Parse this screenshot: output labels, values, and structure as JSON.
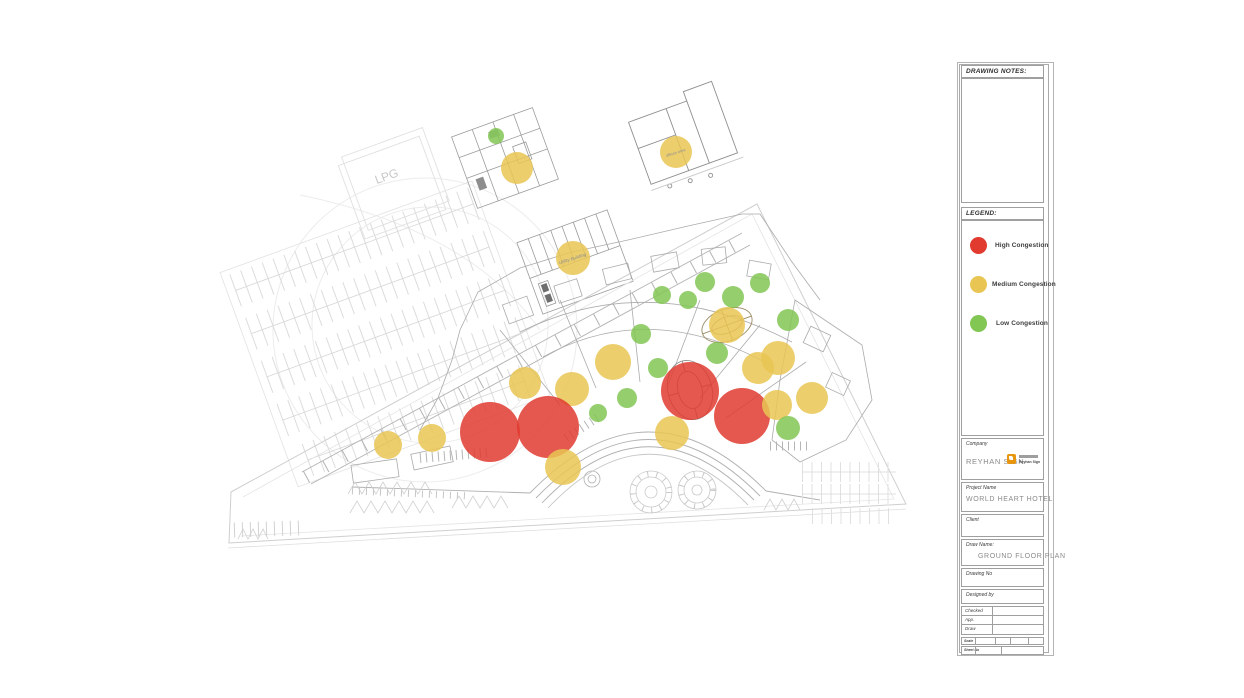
{
  "page": {
    "background": "#ffffff"
  },
  "colors": {
    "high": "#e13b30",
    "medium": "#e9c653",
    "low": "#82c654",
    "marker_opacity": 0.85,
    "plan_line_light": "#dcdcdc",
    "plan_line_mid": "#b9b9b9",
    "plan_line_dark": "#9a9a9a"
  },
  "sheet": {
    "drawing_notes_label": "DRAWING NOTES:",
    "legend_label": "LEGEND:",
    "legend": [
      {
        "level": "high",
        "label": "High Congestion",
        "color": "#e13b30"
      },
      {
        "level": "medium",
        "label": "Medium Congestion",
        "color": "#e9c653"
      },
      {
        "level": "low",
        "label": "Low Congestion",
        "color": "#82c654"
      }
    ],
    "company_label": "Company",
    "company_value": "REYHAN SIGN",
    "logo_text": "Reyhan Sign",
    "project_label": "Project Name",
    "project_value": "WORLD HEART HOTEL",
    "client_label": "Client",
    "client_value": "",
    "draw_name_label": "Draw  Name:",
    "draw_name_value": "GROUND FLOOR PLAN",
    "drawing_no_label": "Drawing No",
    "designed_by_label": "Designed by",
    "approval_rows": [
      {
        "label": "Checked",
        "value": ""
      },
      {
        "label": "App.",
        "value": ""
      },
      {
        "label": "Draw",
        "value": ""
      }
    ],
    "scale_label": "Scale",
    "sheet_no_label": "Sheet No"
  },
  "plan": {
    "title_labels": [
      {
        "text": "LPG",
        "x": 388,
        "y": 180,
        "size": 12,
        "rot": -20,
        "color": "#c8c8c8"
      },
      {
        "text": "Utility Building",
        "x": 573,
        "y": 260,
        "size": 4.5,
        "rot": -18,
        "color": "#8f8f8f"
      },
      {
        "text": "offices area",
        "x": 676,
        "y": 154,
        "size": 4,
        "rot": -18,
        "color": "#8f8f8f"
      }
    ],
    "markers": [
      {
        "level": "low",
        "x": 496,
        "y": 136,
        "r": 8
      },
      {
        "level": "medium",
        "x": 517,
        "y": 168,
        "r": 16
      },
      {
        "level": "medium",
        "x": 573,
        "y": 258,
        "r": 17
      },
      {
        "level": "medium",
        "x": 676,
        "y": 152,
        "r": 16
      },
      {
        "level": "low",
        "x": 705,
        "y": 282,
        "r": 10
      },
      {
        "level": "low",
        "x": 760,
        "y": 283,
        "r": 10
      },
      {
        "level": "low",
        "x": 662,
        "y": 295,
        "r": 9
      },
      {
        "level": "low",
        "x": 688,
        "y": 300,
        "r": 9
      },
      {
        "level": "low",
        "x": 733,
        "y": 297,
        "r": 11
      },
      {
        "level": "low",
        "x": 788,
        "y": 320,
        "r": 11
      },
      {
        "level": "medium",
        "x": 727,
        "y": 325,
        "r": 18
      },
      {
        "level": "low",
        "x": 641,
        "y": 334,
        "r": 10
      },
      {
        "level": "low",
        "x": 717,
        "y": 353,
        "r": 11
      },
      {
        "level": "medium",
        "x": 613,
        "y": 362,
        "r": 18
      },
      {
        "level": "low",
        "x": 658,
        "y": 368,
        "r": 10
      },
      {
        "level": "medium",
        "x": 572,
        "y": 389,
        "r": 17
      },
      {
        "level": "medium",
        "x": 525,
        "y": 383,
        "r": 16
      },
      {
        "level": "medium",
        "x": 778,
        "y": 358,
        "r": 17
      },
      {
        "level": "medium",
        "x": 758,
        "y": 368,
        "r": 16
      },
      {
        "level": "high",
        "x": 690,
        "y": 391,
        "r": 29
      },
      {
        "level": "high",
        "x": 742,
        "y": 416,
        "r": 28
      },
      {
        "level": "medium",
        "x": 777,
        "y": 405,
        "r": 15
      },
      {
        "level": "medium",
        "x": 812,
        "y": 398,
        "r": 16
      },
      {
        "level": "low",
        "x": 627,
        "y": 398,
        "r": 10
      },
      {
        "level": "low",
        "x": 598,
        "y": 413,
        "r": 9
      },
      {
        "level": "high",
        "x": 490,
        "y": 432,
        "r": 30
      },
      {
        "level": "high",
        "x": 548,
        "y": 427,
        "r": 31
      },
      {
        "level": "medium",
        "x": 388,
        "y": 445,
        "r": 14
      },
      {
        "level": "medium",
        "x": 432,
        "y": 438,
        "r": 14
      },
      {
        "level": "medium",
        "x": 672,
        "y": 433,
        "r": 17
      },
      {
        "level": "low",
        "x": 788,
        "y": 428,
        "r": 12
      },
      {
        "level": "medium",
        "x": 563,
        "y": 467,
        "r": 18
      }
    ]
  }
}
